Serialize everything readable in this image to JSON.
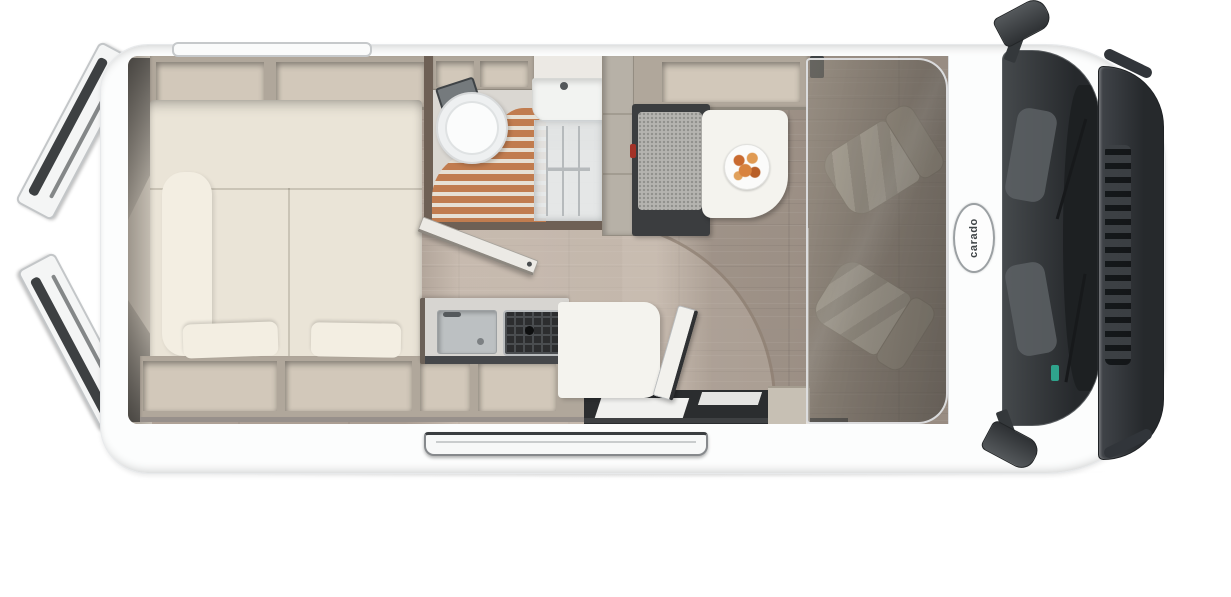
{
  "brand": {
    "logo_text": "carado"
  },
  "image_kind": "top-view 3D floor plan rendering of a campervan",
  "palette": {
    "body": "#fcfdfd",
    "wall": "#b0a79b",
    "cabinet_interior": "#d2c8ba",
    "bed": "#eae4d7",
    "pillow": "#f3eee2",
    "floor": "#a89b90",
    "shower_wood": "#c17c4f",
    "shower_gap": "#e7e0d4",
    "bench": "#b5b4b0",
    "dark_unit": "#3b3d3f",
    "table": "#f4f3ee",
    "food": "#d8833f",
    "glass": "#34383b",
    "grille": "#2c2f32",
    "seat": "#c6bfb2",
    "logo_ink": "#3f4447",
    "bath_wall": "#6e6055",
    "stainless": "#bcc0c2"
  },
  "zones": [
    {
      "id": "rear-doors",
      "label": "rear doors shown open"
    },
    {
      "id": "rear-bed",
      "label": "rear transverse double bed with pillows"
    },
    {
      "id": "overhead-lockers",
      "label": "overhead storage lockers along both walls"
    },
    {
      "id": "bathroom",
      "label": "bathroom with toilet, washbasin and wooden shower grate"
    },
    {
      "id": "wardrobe",
      "label": "tall cabinet / fridge column"
    },
    {
      "id": "dinette",
      "label": "bench seat and table with plate of food"
    },
    {
      "id": "kitchen",
      "label": "kitchen block with sink and hob, worktop extension"
    },
    {
      "id": "entry",
      "label": "sliding entry door with exterior step"
    },
    {
      "id": "cab",
      "label": "driver cab with two swivel seats, windshield and grille"
    }
  ]
}
